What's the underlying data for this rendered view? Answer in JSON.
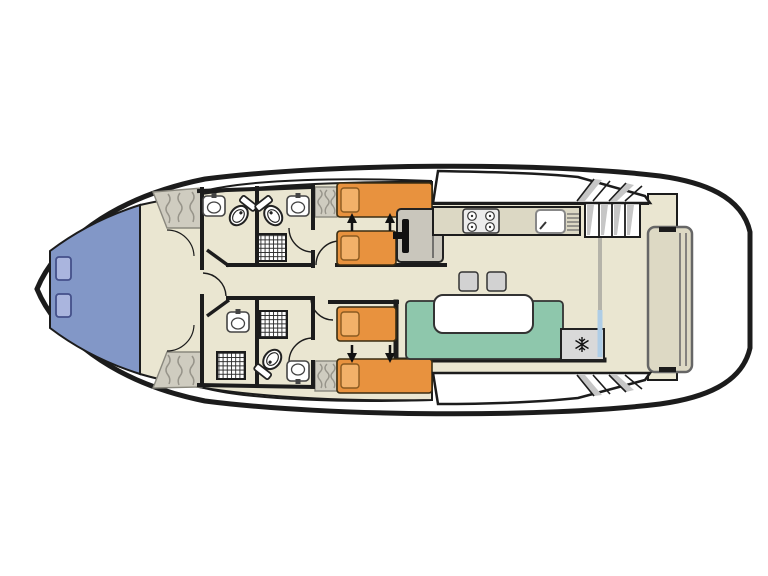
{
  "page": {
    "type": "boat deck floor plan, top view",
    "background": "#ffffff"
  },
  "colors": {
    "hull_outline": "#1c1c1c",
    "deck_white": "#ffffff",
    "floor": "#eae6d1",
    "wall": "#1c1c1c",
    "bow_bed_blue": "#8297c7",
    "bow_pillow": "#aab5de",
    "bow_pillow_border": "#44508a",
    "wardrobe": "#cfccc0",
    "wardrobe_lines": "#97948a",
    "bed_orange": "#e8923e",
    "bed_pillow": "#f2b169",
    "bed_border": "#3a2d12",
    "pillow_border": "#8a5a20",
    "bench_teal": "#8ec7ac",
    "table_white": "#ffffff",
    "counter": "#dcd8c4",
    "appliance_white": "#ececec",
    "helm_gray": "#c9c6bc",
    "stool_gray": "#d2d2d2",
    "fridge_gray": "#d9d9d9",
    "stairs_shade": "#c6c6c6",
    "partition_gray": "#b5b3a9",
    "patio_door_blue": "#aecde6",
    "stern_bench": "#ddd9c4",
    "fixture_stroke": "#333333",
    "fixture_fill": "#ffffff",
    "arrow_black": "#111111"
  },
  "inventory": {
    "bow_cabin": {
      "bed": "V-shaped double berth",
      "pillows": 2,
      "wardrobes": 2
    },
    "top_mid_cabin": {
      "beds": "2 single beds with slide-together arrows",
      "wardrobes": 1
    },
    "bottom_mid_cabin": {
      "beds": "2 single beds with slide-together arrows",
      "wardrobes": 1
    },
    "bathrooms": [
      {
        "id": "top-forward",
        "fixtures": [
          "washbasin",
          "toilet"
        ]
      },
      {
        "id": "top-aft",
        "fixtures": [
          "toilet",
          "washbasin",
          "shower"
        ]
      },
      {
        "id": "bottom-forward",
        "fixtures": [
          "washbasin",
          "shower"
        ]
      },
      {
        "id": "bottom-aft",
        "fixtures": [
          "shower",
          "toilet",
          "washbasin"
        ]
      }
    ],
    "galley": [
      "four-burner stove",
      "sink with drainer",
      "counter"
    ],
    "saloon": [
      "teal bench seating",
      "white dining table",
      "2 stools",
      "refrigerator with snowflake symbol"
    ],
    "helm": "steering station with seat",
    "aft": [
      "stairs to top deck",
      "gray partition",
      "sliding patio door",
      "aft deck",
      "stern bench",
      "side-deck steps port and starboard"
    ]
  }
}
